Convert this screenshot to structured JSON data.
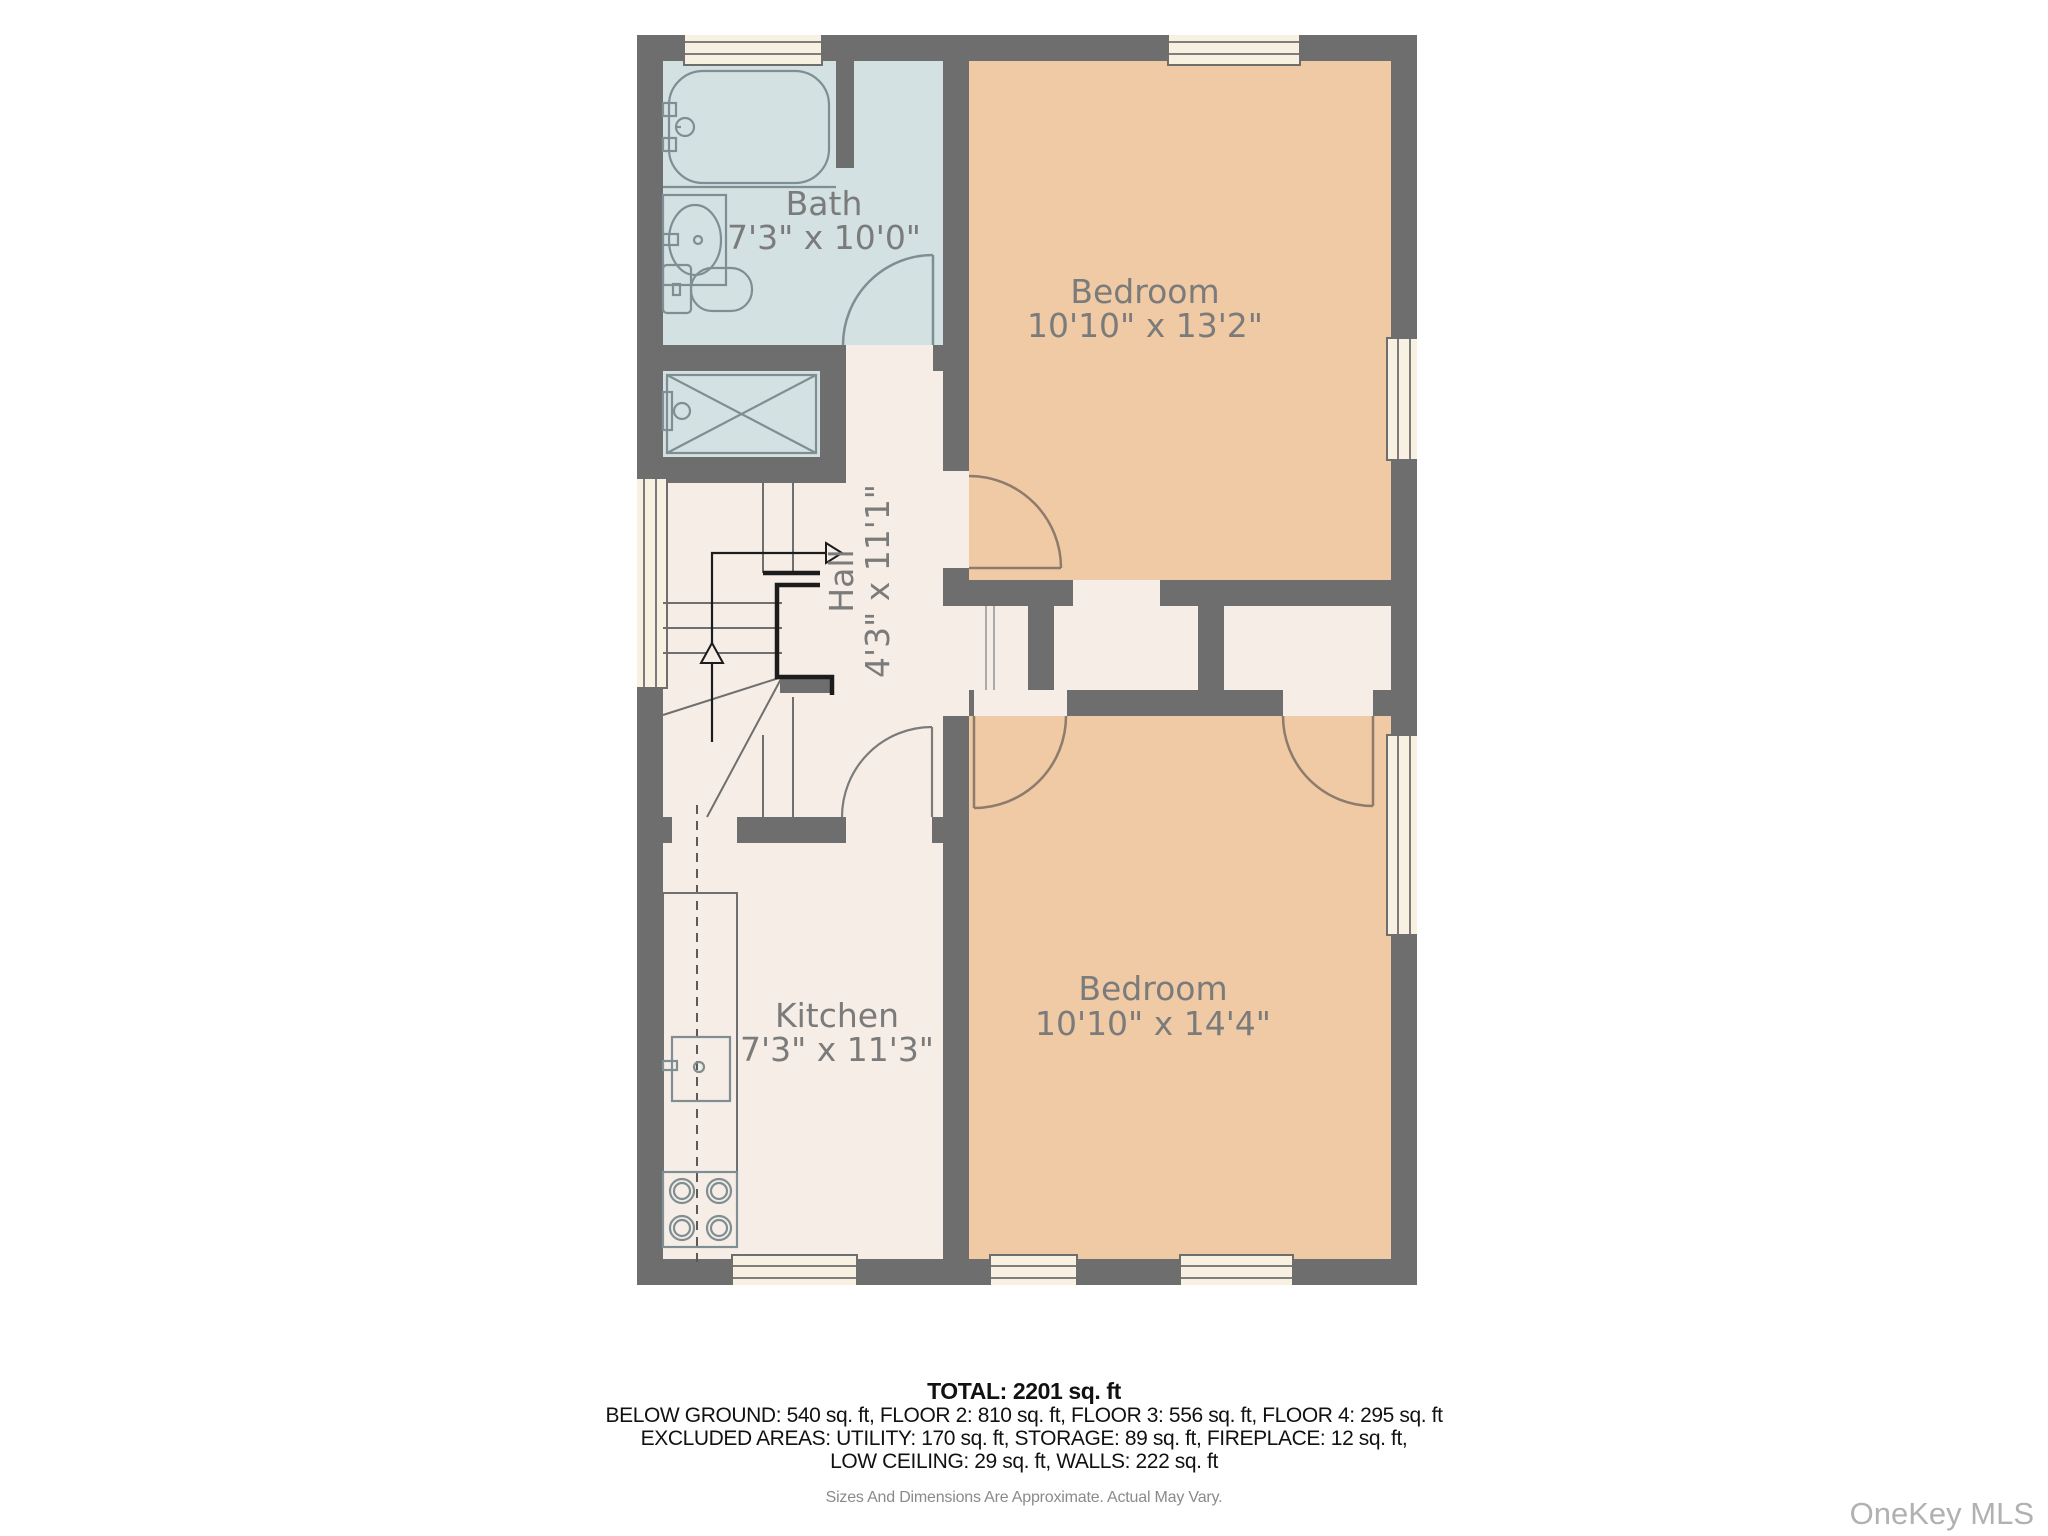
{
  "rooms": [
    {
      "name": "Bath",
      "dims": "7'3\" x 10'0\""
    },
    {
      "name": "Bedroom",
      "dims": "10'10\" x 13'2\""
    },
    {
      "name": "Hall",
      "dims": "4'3\" x 11'1\""
    },
    {
      "name": "Kitchen",
      "dims": "7'3\" x 11'3\""
    },
    {
      "name": "Bedroom",
      "dims": "10'10\" x 14'4\""
    }
  ],
  "summary": {
    "total": "TOTAL: 2201 sq. ft",
    "floors": "BELOW GROUND: 540 sq. ft, FLOOR 2: 810 sq. ft, FLOOR 3: 556 sq. ft, FLOOR 4: 295 sq. ft",
    "excluded_line1": "EXCLUDED AREAS: UTILITY: 170 sq. ft, STORAGE: 89 sq. ft, FIREPLACE: 12 sq. ft,",
    "excluded_line2": "LOW CEILING: 29 sq. ft, WALLS: 222 sq. ft",
    "disclaimer": "Sizes And Dimensions Are Approximate. Actual May Vary."
  },
  "watermark": "OneKey MLS",
  "colors": {
    "wall": "#6e6e6e",
    "room_cream": "#f6eee6",
    "bath_blue": "#d3e1e3",
    "bedroom_tan": "#efcaa4",
    "window_cream": "#f8f1e2",
    "label_gray": "#7b7b7b",
    "fixture": "#7f8e92",
    "door_brown": "#8d7b6c"
  }
}
